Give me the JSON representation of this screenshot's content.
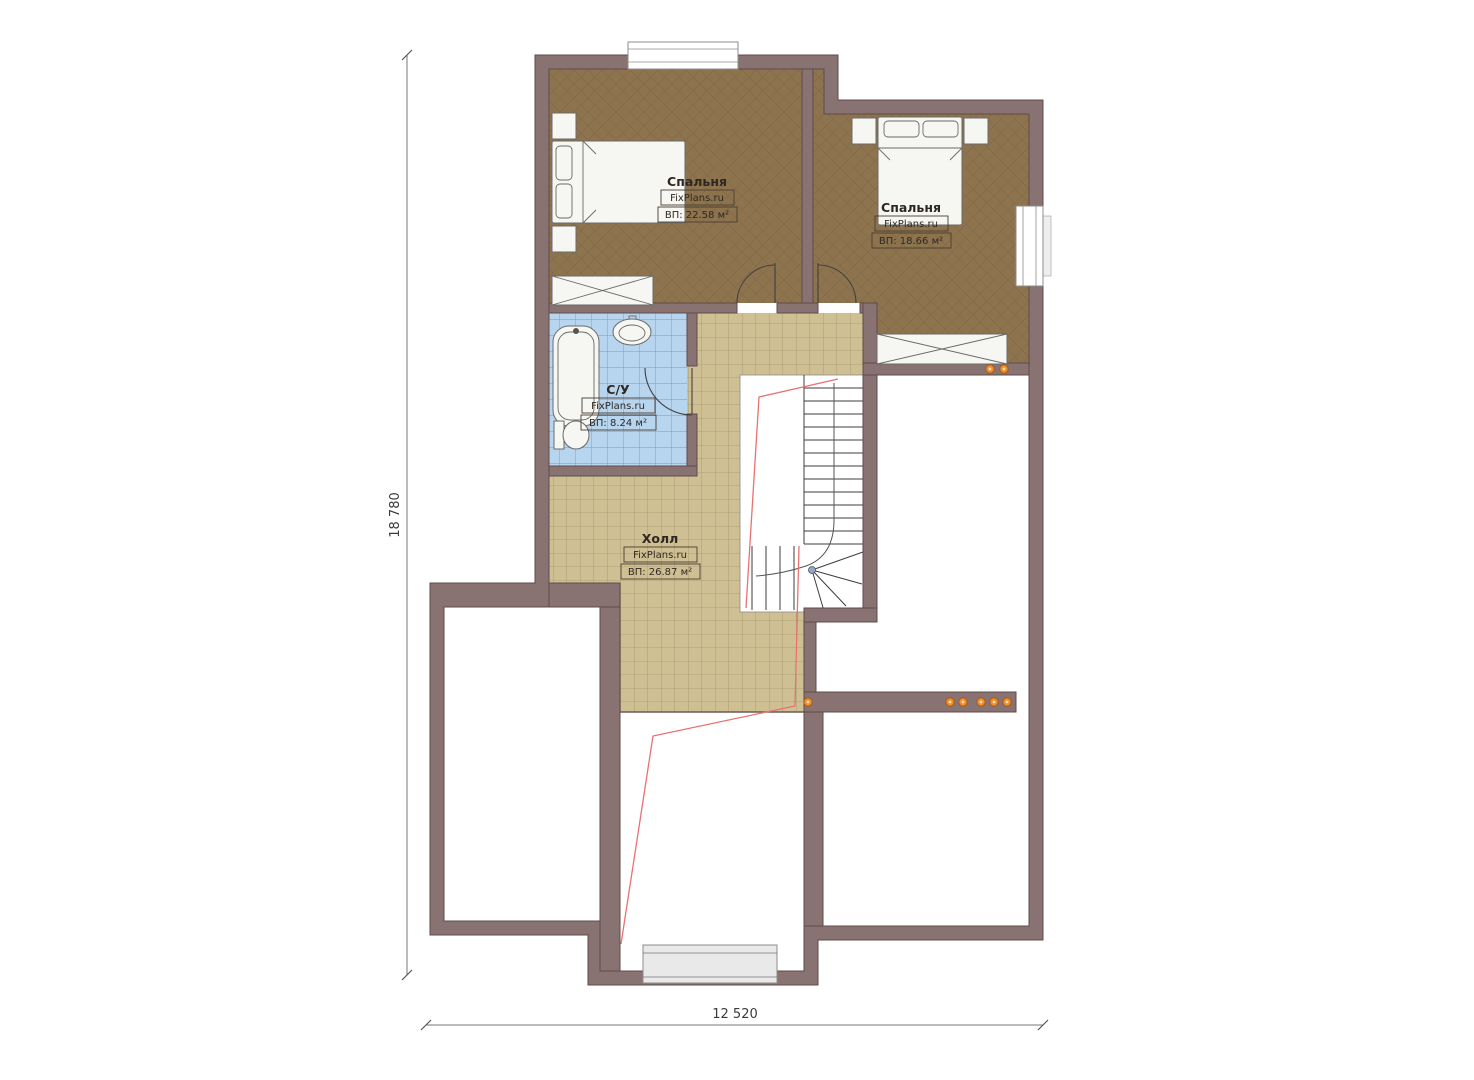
{
  "plan": {
    "dimension_vertical": "18 780",
    "dimension_horizontal": "12 520",
    "rooms": [
      {
        "key": "bedroom-1",
        "name": "Спальня",
        "brand": "FixPlans.ru",
        "area": "ВП: 22.58 м²"
      },
      {
        "key": "bedroom-2",
        "name": "Спальня",
        "brand": "FixPlans.ru",
        "area": "ВП: 18.66 м²"
      },
      {
        "key": "bathroom",
        "name": "С/У",
        "brand": "FixPlans.ru",
        "area": "ВП: 8.24 м²"
      },
      {
        "key": "hall",
        "name": "Холл",
        "brand": "FixPlans.ru",
        "area": "ВП: 26.87 м²"
      }
    ],
    "colors": {
      "wall": "#897372",
      "wall_outline": "#5f4b4a",
      "bedroom_floor": "#8d744e",
      "bedroom_hatch": "#7c6442",
      "hall_tile": "#cfc094",
      "hall_tile_line": "#a6956e",
      "bath_tile": "#b7d5ef",
      "bath_tile_line": "#6f9dc9",
      "roof_slope_line": "#e87272",
      "orange_marker": "#ef8e2e",
      "window_glass": "#e9e9e9",
      "dimension_text": "#3a3a3a"
    }
  }
}
